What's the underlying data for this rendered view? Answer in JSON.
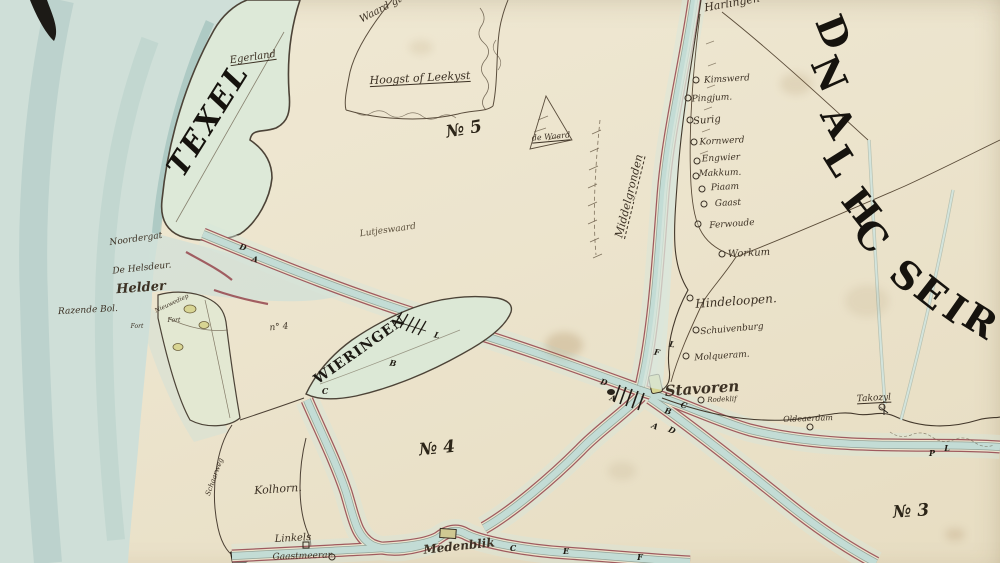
{
  "palette": {
    "paper": "#ece4cd",
    "sea_wash": "#cfdfd8",
    "island_green": "#dde9d8",
    "canal_water": "#c3dcd5",
    "dike_red": "#9a4f55",
    "ink": "#3c3124",
    "title_ink": "#16130e"
  },
  "map": {
    "arc_region": {
      "text": "VRIESCHLAND",
      "letters": [
        {
          "ch": "R",
          "x": 980,
          "y": 321,
          "rot": 32
        },
        {
          "ch": "I",
          "x": 955,
          "y": 309,
          "rot": 35
        },
        {
          "ch": "E",
          "x": 931,
          "y": 293,
          "rot": 38
        },
        {
          "ch": "S",
          "x": 906,
          "y": 276,
          "rot": 42
        },
        {
          "ch": "C",
          "x": 871,
          "y": 236,
          "rot": 48
        },
        {
          "ch": "H",
          "x": 861,
          "y": 207,
          "rot": 52
        },
        {
          "ch": "L",
          "x": 840,
          "y": 161,
          "rot": 58
        },
        {
          "ch": "A",
          "x": 838,
          "y": 122,
          "rot": 62
        },
        {
          "ch": "N",
          "x": 829,
          "y": 74,
          "rot": 66
        },
        {
          "ch": "D",
          "x": 833,
          "y": 32,
          "rot": 68
        }
      ]
    },
    "labels": [
      {
        "name": "label-texel",
        "text": "TEXEL",
        "x": 209,
        "y": 120,
        "size": 30,
        "rot": -58,
        "cls": "texel"
      },
      {
        "name": "label-wieringen",
        "text": "WIERINGEN",
        "x": 360,
        "y": 350,
        "size": 14,
        "rot": -35,
        "cls": "bigcaps"
      },
      {
        "name": "label-egerland",
        "text": "Egerland",
        "x": 253,
        "y": 58,
        "size": 10,
        "rot": -8,
        "u": "solid"
      },
      {
        "name": "label-waardgt",
        "text": "Waard gt",
        "x": 381,
        "y": 10,
        "size": 10,
        "rot": -28
      },
      {
        "name": "label-hoogst-of-leekyst",
        "text": "Hoogst of Leekyst",
        "x": 420,
        "y": 78,
        "size": 11,
        "rot": -3,
        "u": "solid"
      },
      {
        "name": "label-no5",
        "text": "№ 5",
        "x": 464,
        "y": 130,
        "size": 17,
        "rot": -10,
        "cls": "num"
      },
      {
        "name": "label-de-waard",
        "text": "de Waard",
        "x": 551,
        "y": 137,
        "size": 8,
        "rot": -5,
        "u": "solid"
      },
      {
        "name": "label-middelgronden",
        "text": "Middelgronden",
        "x": 629,
        "y": 196,
        "size": 11,
        "rot": -76,
        "u": "dash"
      },
      {
        "name": "label-lutjeswaard",
        "text": "Lutjeswaard",
        "x": 388,
        "y": 231,
        "size": 9,
        "rot": -8,
        "cls": "faded"
      },
      {
        "name": "label-noordergat",
        "text": "Noordergat",
        "x": 136,
        "y": 240,
        "size": 9,
        "rot": -8
      },
      {
        "name": "label-de-helsdeur",
        "text": "De Helsdeur.",
        "x": 142,
        "y": 269,
        "size": 9,
        "rot": -6
      },
      {
        "name": "label-helder",
        "text": "Helder",
        "x": 141,
        "y": 288,
        "size": 13,
        "rot": -4,
        "cls": "scriptbig"
      },
      {
        "name": "label-razende-bol",
        "text": "Razende Bol.",
        "x": 88,
        "y": 311,
        "size": 9,
        "rot": -3
      },
      {
        "name": "label-nieuwediep",
        "text": "Nieuwediep",
        "x": 172,
        "y": 304,
        "size": 6,
        "rot": -25
      },
      {
        "name": "label-fort-west",
        "text": "Fort",
        "x": 137,
        "y": 327,
        "size": 6,
        "rot": 0
      },
      {
        "name": "label-fort-oost",
        "text": "Fort",
        "x": 174,
        "y": 321,
        "size": 6,
        "rot": 0
      },
      {
        "name": "label-harlingen",
        "text": "Harlingen",
        "x": 732,
        "y": 3,
        "size": 11,
        "rot": -10
      },
      {
        "name": "label-kimswerd",
        "text": "Kimswerd",
        "x": 727,
        "y": 80,
        "size": 9,
        "rot": -3
      },
      {
        "name": "label-pingjum",
        "text": "Pingjum.",
        "x": 712,
        "y": 99,
        "size": 9,
        "rot": -3
      },
      {
        "name": "label-surig",
        "text": "Surig",
        "x": 707,
        "y": 121,
        "size": 10,
        "rot": -5
      },
      {
        "name": "label-kornwerd",
        "text": "Kornwerd",
        "x": 722,
        "y": 142,
        "size": 9,
        "rot": -3
      },
      {
        "name": "label-engwier",
        "text": "Engwier",
        "x": 721,
        "y": 159,
        "size": 9,
        "rot": -3
      },
      {
        "name": "label-makkum",
        "text": "Makkum.",
        "x": 720,
        "y": 174,
        "size": 9,
        "rot": -2
      },
      {
        "name": "label-piaam",
        "text": "Piaam",
        "x": 725,
        "y": 188,
        "size": 9,
        "rot": -3
      },
      {
        "name": "label-gaast",
        "text": "Gaast",
        "x": 728,
        "y": 204,
        "size": 9,
        "rot": -3
      },
      {
        "name": "label-ferwoude",
        "text": "Ferwoude",
        "x": 732,
        "y": 225,
        "size": 9,
        "rot": -4
      },
      {
        "name": "label-workum",
        "text": "Workum",
        "x": 749,
        "y": 254,
        "size": 10,
        "rot": -3
      },
      {
        "name": "label-hindeloopen",
        "text": "Hindeloopen.",
        "x": 736,
        "y": 301,
        "size": 12,
        "rot": -4
      },
      {
        "name": "label-schuivenburg",
        "text": "Schuivenburg",
        "x": 732,
        "y": 330,
        "size": 9,
        "rot": -5
      },
      {
        "name": "label-molqueram",
        "text": "Molqueram.",
        "x": 722,
        "y": 357,
        "size": 9,
        "rot": -4
      },
      {
        "name": "label-stavoren",
        "text": "Stavoren",
        "x": 702,
        "y": 389,
        "size": 15,
        "rot": -4,
        "cls": "scriptbig"
      },
      {
        "name": "label-rodeklif",
        "text": "Rodeklif",
        "x": 722,
        "y": 400,
        "size": 7,
        "rot": -2
      },
      {
        "name": "label-takozyl",
        "text": "Takozyl",
        "x": 874,
        "y": 399,
        "size": 9,
        "rot": -3,
        "u": "solid"
      },
      {
        "name": "label-oldeaerdam",
        "text": "Oldeaerdam",
        "x": 808,
        "y": 419,
        "size": 8,
        "rot": -2
      },
      {
        "name": "label-no3",
        "text": "№ 3",
        "x": 911,
        "y": 512,
        "size": 17,
        "rot": -4,
        "cls": "num"
      },
      {
        "name": "label-no4-groot",
        "text": "№ 4",
        "x": 437,
        "y": 449,
        "size": 17,
        "rot": -6,
        "cls": "num"
      },
      {
        "name": "label-n4-klein",
        "text": "n° 4",
        "x": 279,
        "y": 328,
        "size": 9,
        "rot": -5
      },
      {
        "name": "label-kolhorn",
        "text": "Kolhorn.",
        "x": 278,
        "y": 489,
        "size": 11,
        "rot": -4
      },
      {
        "name": "label-linkels",
        "text": "Linkels",
        "x": 293,
        "y": 539,
        "size": 10,
        "rot": -3
      },
      {
        "name": "label-gaastmeeran",
        "text": "Gaastmeeran",
        "x": 303,
        "y": 557,
        "size": 9,
        "rot": -2
      },
      {
        "name": "label-schaarweg",
        "text": "Schaarweg",
        "x": 215,
        "y": 477,
        "size": 7,
        "rot": -70
      },
      {
        "name": "label-medenblik",
        "text": "Medenblik",
        "x": 459,
        "y": 546,
        "size": 12,
        "rot": -6,
        "cls": "scriptbig"
      }
    ],
    "canal_letters": [
      {
        "ch": "D",
        "x": 243,
        "y": 247,
        "rot": 15
      },
      {
        "ch": "A",
        "x": 255,
        "y": 259,
        "rot": 15
      },
      {
        "ch": "C",
        "x": 325,
        "y": 391,
        "rot": 0
      },
      {
        "ch": "B",
        "x": 393,
        "y": 363,
        "rot": 10
      },
      {
        "ch": "L",
        "x": 437,
        "y": 335,
        "rot": 15
      },
      {
        "ch": "F",
        "x": 657,
        "y": 352,
        "rot": 10
      },
      {
        "ch": "L",
        "x": 672,
        "y": 344,
        "rot": 10
      },
      {
        "ch": "D",
        "x": 604,
        "y": 382,
        "rot": 15
      },
      {
        "ch": "A",
        "x": 613,
        "y": 398,
        "rot": 15
      },
      {
        "ch": "B",
        "x": 668,
        "y": 411,
        "rot": 15
      },
      {
        "ch": "C",
        "x": 684,
        "y": 405,
        "rot": 15
      },
      {
        "ch": "A",
        "x": 655,
        "y": 426,
        "rot": 25
      },
      {
        "ch": "D",
        "x": 672,
        "y": 430,
        "rot": 25
      },
      {
        "ch": "P",
        "x": 932,
        "y": 453,
        "rot": 0
      },
      {
        "ch": "L",
        "x": 947,
        "y": 448,
        "rot": 0
      },
      {
        "ch": "C",
        "x": 513,
        "y": 548,
        "rot": 0
      },
      {
        "ch": "E",
        "x": 566,
        "y": 551,
        "rot": 0
      },
      {
        "ch": "F",
        "x": 640,
        "y": 557,
        "rot": 0
      }
    ],
    "markers": {
      "circles": [
        {
          "x": 696,
          "y": 80
        },
        {
          "x": 688,
          "y": 98
        },
        {
          "x": 690,
          "y": 120
        },
        {
          "x": 694,
          "y": 142
        },
        {
          "x": 697,
          "y": 161
        },
        {
          "x": 696,
          "y": 176
        },
        {
          "x": 702,
          "y": 189
        },
        {
          "x": 704,
          "y": 204
        },
        {
          "x": 698,
          "y": 224
        },
        {
          "x": 722,
          "y": 254
        },
        {
          "x": 690,
          "y": 298
        },
        {
          "x": 696,
          "y": 330
        },
        {
          "x": 686,
          "y": 356
        },
        {
          "x": 701,
          "y": 400
        },
        {
          "x": 882,
          "y": 407
        },
        {
          "x": 810,
          "y": 427
        },
        {
          "x": 332,
          "y": 557
        }
      ],
      "squares": [
        {
          "x": 306,
          "y": 545
        }
      ]
    }
  }
}
